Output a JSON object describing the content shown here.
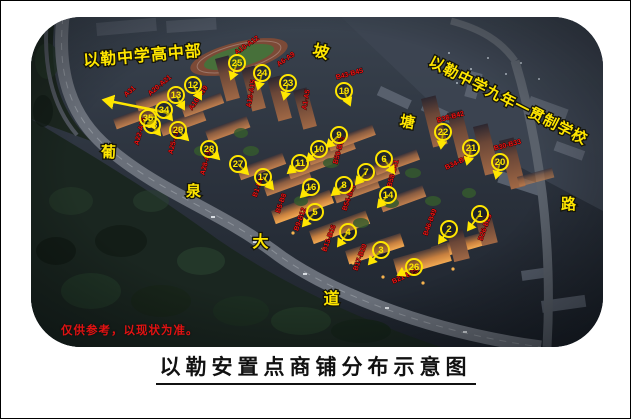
{
  "window": {
    "caption": "以勒安置点商铺分布示意图",
    "disclaimer": "仅供参考，以现状为准。"
  },
  "map": {
    "colors": {
      "annotation_yellow": "#ffe600",
      "annotation_red": "#ee1515",
      "road_grey": "#6a707a"
    },
    "place_labels": [
      {
        "t": "以勒中学高中部",
        "x": 142,
        "y": 60,
        "r": -5,
        "s": 16
      },
      {
        "t": "坡",
        "x": 319,
        "y": 56,
        "r": 15,
        "s": 16
      },
      {
        "t": "以勒中学九年一贯制学校",
        "x": 505,
        "y": 104,
        "r": 27,
        "s": 15
      },
      {
        "t": "塘",
        "x": 406,
        "y": 126,
        "r": 10,
        "s": 15
      },
      {
        "t": "路",
        "x": 568,
        "y": 208,
        "r": 0,
        "s": 15
      },
      {
        "t": "葡",
        "x": 108,
        "y": 156,
        "r": 0,
        "s": 15
      },
      {
        "t": "泉",
        "x": 193,
        "y": 195,
        "r": 0,
        "s": 15
      },
      {
        "t": "大",
        "x": 260,
        "y": 246,
        "r": 0,
        "s": 16
      },
      {
        "t": "道",
        "x": 331,
        "y": 303,
        "r": 0,
        "s": 16
      }
    ],
    "building_circles": [
      {
        "n": "1",
        "x": 479,
        "y": 213,
        "tx": -12,
        "ty": 16
      },
      {
        "n": "2",
        "x": 448,
        "y": 228,
        "tx": -10,
        "ty": 14
      },
      {
        "n": "3",
        "x": 380,
        "y": 249,
        "tx": -12,
        "ty": 14
      },
      {
        "n": "4",
        "x": 347,
        "y": 231,
        "tx": -10,
        "ty": 14
      },
      {
        "n": "5",
        "x": 314,
        "y": 211,
        "tx": -12,
        "ty": 14
      },
      {
        "n": "6",
        "x": 383,
        "y": 158,
        "tx": 10,
        "ty": 14
      },
      {
        "n": "7",
        "x": 365,
        "y": 171,
        "tx": -10,
        "ty": 12
      },
      {
        "n": "8",
        "x": 343,
        "y": 184,
        "tx": -12,
        "ty": 10
      },
      {
        "n": "9",
        "x": 338,
        "y": 134,
        "tx": -12,
        "ty": 12
      },
      {
        "n": "10",
        "x": 318,
        "y": 148,
        "tx": -12,
        "ty": 12
      },
      {
        "n": "11",
        "x": 299,
        "y": 162,
        "tx": -12,
        "ty": 10
      },
      {
        "n": "12",
        "x": 192,
        "y": 84,
        "tx": 8,
        "ty": 14
      },
      {
        "n": "13",
        "x": 175,
        "y": 94,
        "tx": 8,
        "ty": 14
      },
      {
        "n": "14",
        "x": 387,
        "y": 194,
        "tx": -10,
        "ty": 12
      },
      {
        "n": "16",
        "x": 310,
        "y": 186,
        "tx": -10,
        "ty": 10
      },
      {
        "n": "17",
        "x": 262,
        "y": 176,
        "tx": 10,
        "ty": 12
      },
      {
        "n": "19",
        "x": 343,
        "y": 90,
        "tx": 6,
        "ty": 14
      },
      {
        "n": "20",
        "x": 499,
        "y": 161,
        "tx": -4,
        "ty": 16
      },
      {
        "n": "21",
        "x": 470,
        "y": 147,
        "tx": -4,
        "ty": 16
      },
      {
        "n": "22",
        "x": 442,
        "y": 131,
        "tx": -2,
        "ty": 16
      },
      {
        "n": "23",
        "x": 287,
        "y": 82,
        "tx": -4,
        "ty": 16
      },
      {
        "n": "24",
        "x": 261,
        "y": 72,
        "tx": -4,
        "ty": 16
      },
      {
        "n": "25",
        "x": 236,
        "y": 62,
        "tx": -6,
        "ty": 16
      },
      {
        "n": "26",
        "x": 413,
        "y": 266,
        "tx": -16,
        "ty": 8
      },
      {
        "n": "27",
        "x": 237,
        "y": 163,
        "tx": 10,
        "ty": 10
      },
      {
        "n": "28",
        "x": 208,
        "y": 148,
        "tx": 10,
        "ty": 10
      },
      {
        "n": "29",
        "x": 177,
        "y": 129,
        "tx": 10,
        "ty": 10
      },
      {
        "n": "33",
        "x": 151,
        "y": 124,
        "tx": 8,
        "ty": 10
      },
      {
        "n": "34",
        "x": 163,
        "y": 109,
        "tx": 8,
        "ty": 10
      },
      {
        "n": "35",
        "x": 147,
        "y": 117,
        "tx": 6,
        "ty": 10
      }
    ],
    "shop_range_labels": [
      {
        "t": "A31",
        "x": 130,
        "y": 92,
        "r": -40
      },
      {
        "t": "A20-A21",
        "x": 160,
        "y": 86,
        "r": -40
      },
      {
        "t": "A16-A19",
        "x": 199,
        "y": 98,
        "r": -55
      },
      {
        "t": "A10-A12",
        "x": 247,
        "y": 46,
        "r": -35
      },
      {
        "t": "A13-A15",
        "x": 252,
        "y": 93,
        "r": -80
      },
      {
        "t": "A6-A9",
        "x": 286,
        "y": 60,
        "r": -35
      },
      {
        "t": "A1-A5",
        "x": 307,
        "y": 99,
        "r": -80
      },
      {
        "t": "A22-A24",
        "x": 141,
        "y": 131,
        "r": -75
      },
      {
        "t": "A25-A27",
        "x": 175,
        "y": 140,
        "r": -75
      },
      {
        "t": "A28-A30",
        "x": 207,
        "y": 161,
        "r": -75
      },
      {
        "t": "B43-B45",
        "x": 349,
        "y": 75,
        "r": -15
      },
      {
        "t": "B38-B42",
        "x": 450,
        "y": 118,
        "r": -15
      },
      {
        "t": "B34-B37",
        "x": 458,
        "y": 163,
        "r": -25
      },
      {
        "t": "B30-B33",
        "x": 507,
        "y": 146,
        "r": -15
      },
      {
        "t": "B50-B53",
        "x": 340,
        "y": 150,
        "r": -75
      },
      {
        "t": "B54-B57",
        "x": 350,
        "y": 197,
        "r": -70
      },
      {
        "t": "B58-B61",
        "x": 394,
        "y": 173,
        "r": -75
      },
      {
        "t": "B46-B49",
        "x": 431,
        "y": 222,
        "r": -70
      },
      {
        "t": "B26-B29",
        "x": 486,
        "y": 227,
        "r": -70
      },
      {
        "t": "B21-B25",
        "x": 405,
        "y": 277,
        "r": -25
      },
      {
        "t": "B17-B20",
        "x": 361,
        "y": 257,
        "r": -70
      },
      {
        "t": "B13-B16",
        "x": 330,
        "y": 238,
        "r": -70
      },
      {
        "t": "B9-B12",
        "x": 301,
        "y": 219,
        "r": -70
      },
      {
        "t": "B5-B8",
        "x": 282,
        "y": 203,
        "r": -70
      },
      {
        "t": "B1-B4",
        "x": 259,
        "y": 187,
        "r": -70
      }
    ],
    "arrow": {
      "x1": 168,
      "y1": 112,
      "x2": 103,
      "y2": 99
    }
  }
}
